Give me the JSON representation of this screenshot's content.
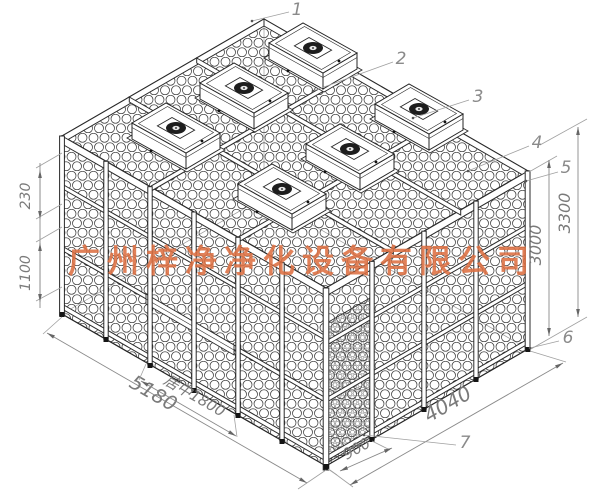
{
  "watermark": {
    "text": "广州梓净净化设备有限公司",
    "color": "#dd6f42"
  },
  "callouts": {
    "c1": "1",
    "c2": "2",
    "c3": "3",
    "c4": "4",
    "c5": "5",
    "c6": "6",
    "c7": "7"
  },
  "dimensions": {
    "left_top": "230",
    "left_mid": "1100",
    "right_outer": "3300",
    "right_inner": "3000",
    "front_width": "5180",
    "front_door": "居中1800",
    "side_door": "900",
    "side_width": "4040"
  },
  "colors": {
    "background": "#ffffff",
    "line": "#2a2a2a",
    "dimension": "#7a7a7a",
    "watermark": "#dd6f42"
  }
}
